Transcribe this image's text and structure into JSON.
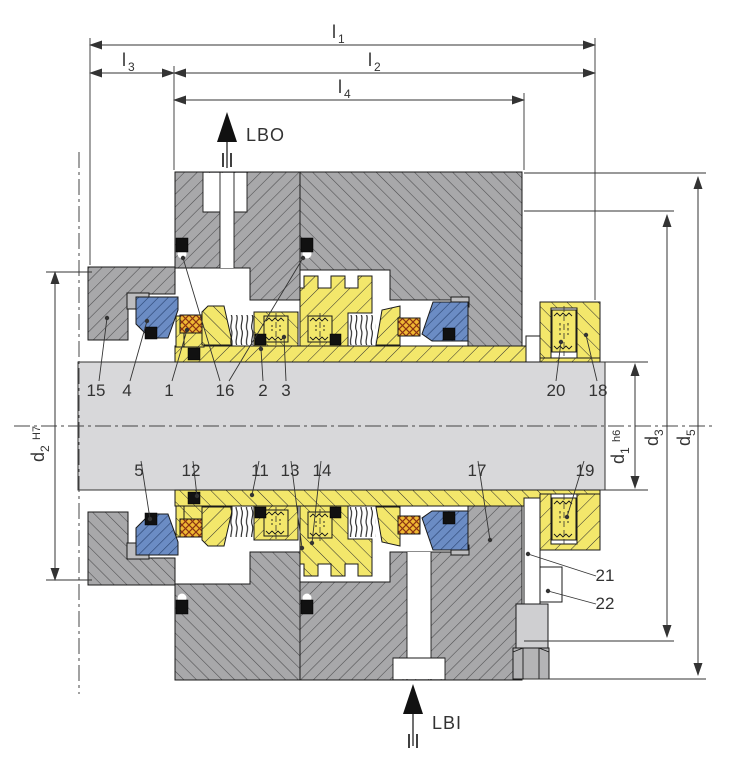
{
  "meta": {
    "description": "Cross-section technical drawing of a dual cartridge mechanical shaft seal with dimension lines and numbered part callouts"
  },
  "dimensions": {
    "l1": {
      "main": "l",
      "sub": "1"
    },
    "l2": {
      "main": "l",
      "sub": "2"
    },
    "l3": {
      "main": "l",
      "sub": "3"
    },
    "l4": {
      "main": "l",
      "sub": "4"
    },
    "d1": {
      "main": "d",
      "sub": "1",
      "tol": "h6"
    },
    "d2": {
      "main": "d",
      "sub": "2",
      "tol": "H7"
    },
    "d3": {
      "main": "d",
      "sub": "3"
    },
    "d5": {
      "main": "d",
      "sub": "5"
    }
  },
  "ports": {
    "lbo": "LBO",
    "lbi": "LBI"
  },
  "part_labels": {
    "1": "1",
    "2": "2",
    "3": "3",
    "4": "4",
    "5": "5",
    "11": "11",
    "12": "12",
    "13": "13",
    "14": "14",
    "15": "15",
    "16": "16",
    "17": "17",
    "18": "18",
    "19": "19",
    "20": "20",
    "21": "21",
    "22": "22"
  },
  "colors": {
    "housing_gray": "#a8a8aa",
    "shaft_gray": "#d8d8da",
    "component_yellow": "#f3e76b",
    "seal_face_blue": "#6b8cc4",
    "packing_orange": "#f0b832",
    "oring_black": "#111111",
    "line": "#1a1a1a",
    "background": "#ffffff"
  }
}
